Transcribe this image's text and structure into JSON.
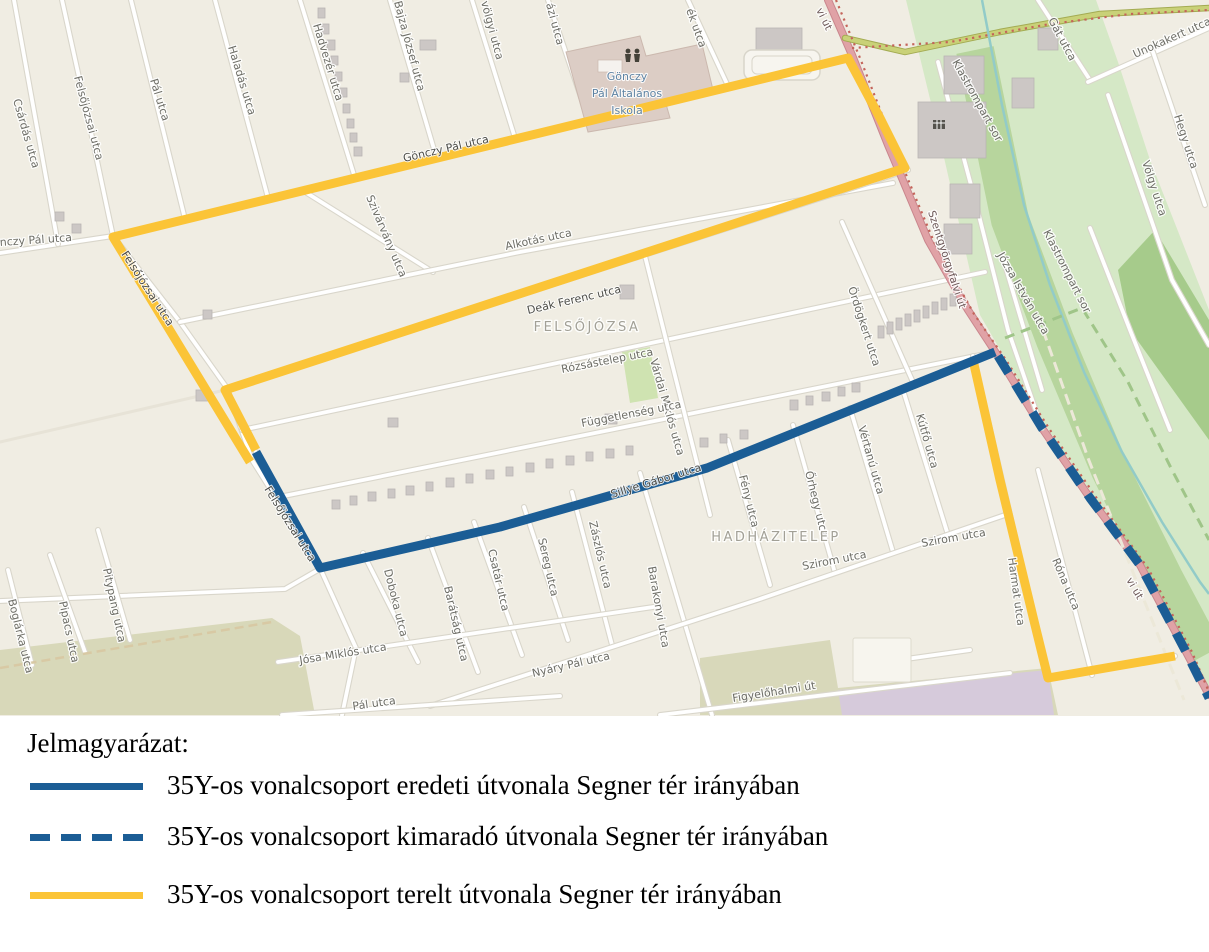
{
  "app": {
    "title": "35Y route diversion map"
  },
  "legend": {
    "title": "Jelmagyarázat:",
    "items": [
      {
        "key": "original",
        "swatch": "solid-blue",
        "label": "35Y-os vonalcsoport eredeti útvonala Segner tér irányában"
      },
      {
        "key": "omitted",
        "swatch": "dashed-blue",
        "label": "35Y-os vonalcsoport kimaradó útvonala Segner tér irányában"
      },
      {
        "key": "diverted",
        "swatch": "solid-yellow",
        "label": "35Y-os vonalcsoport terelt útvonala Segner tér irányában"
      }
    ]
  },
  "colors": {
    "route_blue": "#1b5d95",
    "route_yellow": "#fbc437",
    "main_road_pink": "#e0a2a6",
    "map_background": "#f0ede3",
    "green_area": "#d5e8c6"
  },
  "map": {
    "place_labels": [
      {
        "t": "FELSŐJÓZSA",
        "x": 587,
        "y": 331,
        "r": 0,
        "v": "place"
      },
      {
        "t": "HADHÁZITELEP",
        "x": 776,
        "y": 541,
        "r": 0,
        "v": "place"
      }
    ],
    "poi_labels": [
      {
        "t": "Gönczy",
        "x": 627,
        "y": 80,
        "r": 0,
        "v": "poi"
      },
      {
        "t": "Pál Általános",
        "x": 627,
        "y": 97,
        "r": 0,
        "v": "poi"
      },
      {
        "t": "Iskola",
        "x": 627,
        "y": 114,
        "r": 0,
        "v": "poi"
      }
    ],
    "street_labels": [
      {
        "t": "Csárdás utca",
        "x": 13,
        "y": 100,
        "r": 74
      },
      {
        "t": "Felsőjózsai utca",
        "x": 74,
        "y": 77,
        "r": 75
      },
      {
        "t": "Pál utca",
        "x": 150,
        "y": 80,
        "r": 73
      },
      {
        "t": "Haladás utca",
        "x": 228,
        "y": 47,
        "r": 73
      },
      {
        "t": "Hadvezér utca",
        "x": 313,
        "y": 25,
        "r": 73
      },
      {
        "t": "Bajza József utca",
        "x": 394,
        "y": 2,
        "r": 75
      },
      {
        "t": "völgyi utca",
        "x": 481,
        "y": 2,
        "r": 75
      },
      {
        "t": "ázi utca",
        "x": 546,
        "y": 4,
        "r": 75
      },
      {
        "t": "ék utca",
        "x": 686,
        "y": 10,
        "r": 70
      },
      {
        "t": "nczy Pál utca",
        "x": 0,
        "y": 246,
        "r": -4
      },
      {
        "t": "Gönczy Pál utca",
        "x": 404,
        "y": 162,
        "r": -13,
        "v": "onroute"
      },
      {
        "t": "Szivárvány utca",
        "x": 366,
        "y": 197,
        "r": 67
      },
      {
        "t": "Alkotás utca",
        "x": 506,
        "y": 250,
        "r": -12
      },
      {
        "t": "Deák Ferenc utca",
        "x": 528,
        "y": 314,
        "r": -13,
        "v": "onroute"
      },
      {
        "t": "Felsőjózsai utca",
        "x": 121,
        "y": 254,
        "r": 57,
        "v": "onroute"
      },
      {
        "t": "Rózsástelep utca",
        "x": 562,
        "y": 373,
        "r": -11
      },
      {
        "t": "Várdai Miklós utca",
        "x": 650,
        "y": 360,
        "r": 74
      },
      {
        "t": "Függetlenség utca",
        "x": 582,
        "y": 427,
        "r": -11
      },
      {
        "t": "Ördögkert utca",
        "x": 848,
        "y": 288,
        "r": 72
      },
      {
        "t": "Kútfő utca",
        "x": 916,
        "y": 415,
        "r": 74
      },
      {
        "t": "Vértanú utca",
        "x": 858,
        "y": 427,
        "r": 74
      },
      {
        "t": "Őrhegy utca",
        "x": 805,
        "y": 472,
        "r": 76
      },
      {
        "t": "Fény utca",
        "x": 739,
        "y": 476,
        "r": 76
      },
      {
        "t": "Sillye Gábor utca",
        "x": 612,
        "y": 498,
        "r": -17,
        "v": "onroute"
      },
      {
        "t": "Felsőjózsai utca",
        "x": 264,
        "y": 489,
        "r": 58,
        "v": "onroute"
      },
      {
        "t": "Zászlós utca",
        "x": 589,
        "y": 522,
        "r": 77
      },
      {
        "t": "Sereg utca",
        "x": 538,
        "y": 539,
        "r": 77
      },
      {
        "t": "Csatár utca",
        "x": 488,
        "y": 550,
        "r": 77
      },
      {
        "t": "Barátság utca",
        "x": 444,
        "y": 587,
        "r": 77
      },
      {
        "t": "Doboka utca",
        "x": 384,
        "y": 570,
        "r": 76
      },
      {
        "t": "Barakonyi utca",
        "x": 648,
        "y": 567,
        "r": 80
      },
      {
        "t": "Szirom utca",
        "x": 803,
        "y": 570,
        "r": -11
      },
      {
        "t": "Szirom utca",
        "x": 922,
        "y": 547,
        "r": -10
      },
      {
        "t": "Harmat utca",
        "x": 1008,
        "y": 558,
        "r": 82
      },
      {
        "t": "Róna utca",
        "x": 1052,
        "y": 560,
        "r": 67
      },
      {
        "t": "Nyáry Pál utca",
        "x": 533,
        "y": 677,
        "r": -13
      },
      {
        "t": "Jósa Miklós utca",
        "x": 300,
        "y": 664,
        "r": -9
      },
      {
        "t": "Pál utca",
        "x": 353,
        "y": 710,
        "r": -8
      },
      {
        "t": "Figyelőhalmi út",
        "x": 733,
        "y": 702,
        "r": -9
      },
      {
        "t": "Pitypang utca",
        "x": 103,
        "y": 569,
        "r": 78
      },
      {
        "t": "Pipacs utca",
        "x": 59,
        "y": 602,
        "r": 78
      },
      {
        "t": "Boglárka utca",
        "x": 8,
        "y": 600,
        "r": 76
      },
      {
        "t": "Szentgyörgyfalvi út",
        "x": 928,
        "y": 212,
        "r": 72,
        "v": "road"
      },
      {
        "t": "vi út",
        "x": 816,
        "y": 10,
        "r": 64,
        "v": "road"
      },
      {
        "t": "vi út",
        "x": 1126,
        "y": 580,
        "r": 60,
        "v": "road"
      },
      {
        "t": "Klastrompart sor",
        "x": 952,
        "y": 62,
        "r": 61
      },
      {
        "t": "Klastrompart sor",
        "x": 1043,
        "y": 232,
        "r": 63
      },
      {
        "t": "Józsa István utca",
        "x": 997,
        "y": 255,
        "r": 60
      },
      {
        "t": "Gát utca",
        "x": 1048,
        "y": 20,
        "r": 62
      },
      {
        "t": "Unokakert utca",
        "x": 1135,
        "y": 58,
        "r": -24
      },
      {
        "t": "Hegy utca",
        "x": 1174,
        "y": 116,
        "r": 72
      },
      {
        "t": "Völgy utca",
        "x": 1142,
        "y": 162,
        "r": 72
      }
    ],
    "routes": [
      {
        "name": "diverted-route-loop",
        "legend_key": "diverted",
        "color": "#fbc437",
        "width": 9,
        "points": [
          [
            250,
            462
          ],
          [
            113,
            237
          ],
          [
            848,
            58
          ],
          [
            880,
            118
          ],
          [
            905,
            168
          ],
          [
            225,
            390
          ],
          [
            256,
            450
          ]
        ]
      },
      {
        "name": "diverted-route-south",
        "legend_key": "diverted",
        "color": "#fbc437",
        "width": 9,
        "points": [
          [
            973,
            360
          ],
          [
            1000,
            480
          ],
          [
            1035,
            625
          ],
          [
            1048,
            678
          ],
          [
            1175,
            656
          ]
        ]
      },
      {
        "name": "original-route",
        "legend_key": "original",
        "color": "#1b5d95",
        "width": 9,
        "points": [
          [
            256,
            452
          ],
          [
            320,
            568
          ],
          [
            500,
            527
          ],
          [
            707,
            468
          ],
          [
            995,
            352
          ]
        ]
      },
      {
        "name": "omitted-route",
        "legend_key": "omitted",
        "color": "#1b5d95",
        "width": 9,
        "dash": "20 13",
        "points": [
          [
            998,
            356
          ],
          [
            1042,
            428
          ],
          [
            1090,
            498
          ],
          [
            1140,
            565
          ],
          [
            1185,
            650
          ],
          [
            1209,
            698
          ]
        ]
      }
    ]
  }
}
